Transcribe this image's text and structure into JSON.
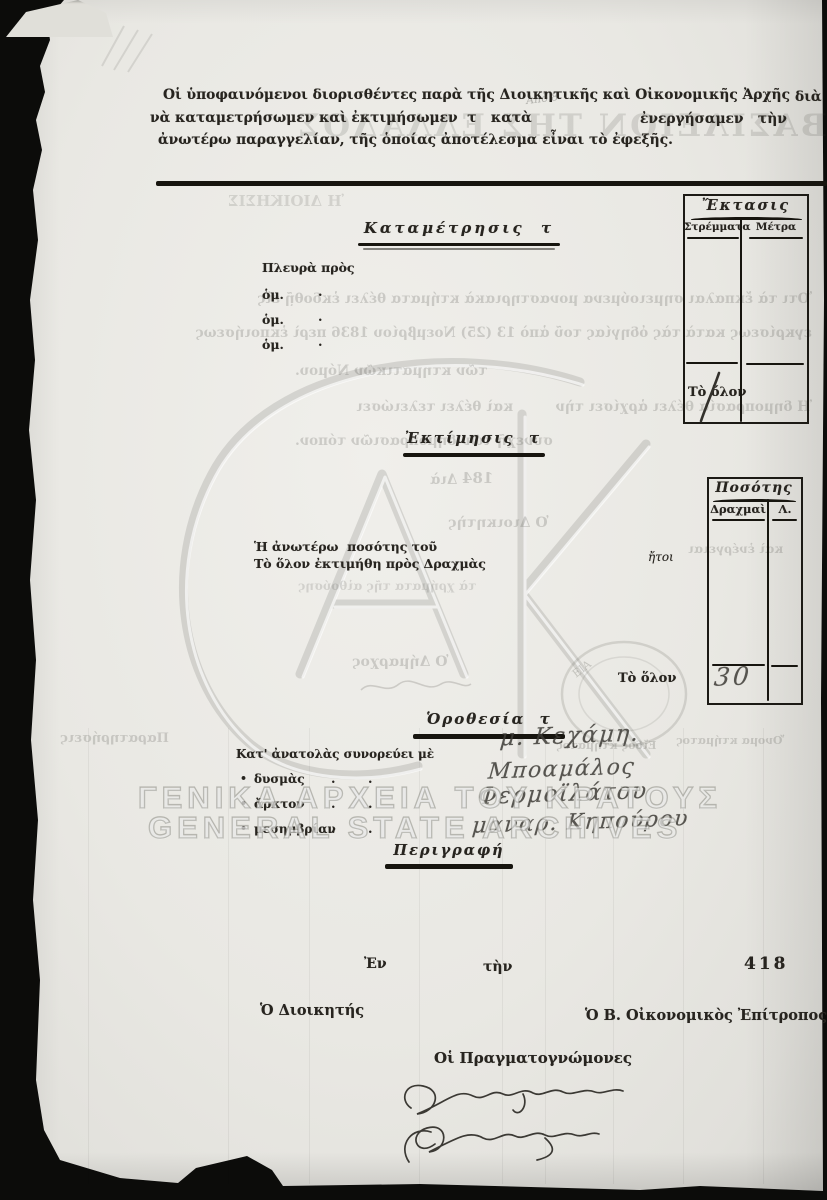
{
  "document": {
    "header": {
      "line1": "Οἱ ὑποφαινόμενοι διορισθέντες παρὰ τῆς Διοικητικῆς καὶ Οἰκονομικῆς Ἀρχῆς",
      "line1_end": "διὰ",
      "line2": "νὰ καταμετρήσωμεν καὶ ἐκτιμήσωμεν  τ   κατὰ",
      "line2_end": "ἐνεργήσαμεν   τὴν",
      "line3": "ἀνωτέρω παραγγελίαν, τῆς ὁποίας ἀποτέλεσμα εἶναι τὸ ἐφεξῆς.",
      "pencil_note": "Ἀπὸ 8"
    },
    "katametrisis": {
      "heading": "Καταμέτρησις  τ",
      "side_label": "Πλευρὰ πρὸς",
      "dim_rows": [
        "ὁμ.",
        "ὁμ.",
        "ὁμ."
      ],
      "dot": ".",
      "total_label": "Τὸ ὅλον"
    },
    "ektasis_table": {
      "title": "Ἔκτασις",
      "col1": "Στρέμματα",
      "col2": "Μέτρα",
      "total_value_handwritten": "1"
    },
    "ektimisis": {
      "heading": "Ἐκτίμησις  τ",
      "line1": "Ἡ ἀνωτέρω  ποσότης τοῦ",
      "line2": "Τὸ ὅλον ἐκτιμήθη πρὸς Δραχμὰς",
      "itoi_label": "ἤτοι",
      "total_label": "Τὸ ὅλον"
    },
    "posotis_table": {
      "title": "Ποσότης",
      "col1": "Δραχμαὶ",
      "col2": "Λ.",
      "total_value_handwritten": "30"
    },
    "orothesia": {
      "heading": "Ὁροθεσία  τ",
      "bullet": "•",
      "east_label": "Κατ' ἀνατολὰς συνορεύει μὲ",
      "west_label": "δυσμὰς",
      "north_label": "ἄρκτον",
      "south_label": "μεσημβρίαν",
      "hw_east": "μ. Κεχάμη.",
      "hw_west": "Μποαμάλος",
      "hw_north": "Φερμοϊλάτου",
      "hw_south": "μαναρ. Κηπούρου"
    },
    "perigrafi_heading": "Περιγραφή",
    "closing": {
      "en_label": "Ἐν",
      "tin_label": "τὴν",
      "protocol_number": "418",
      "governor_label": "Ὁ Διοικητής",
      "commissioner_label": "Ὁ Β. Οἰκονομικὸς Ἐπίτροπος",
      "experts_label": "Οἱ Πραγματογνώμονες"
    }
  },
  "archive_watermark": {
    "greek": "ΓΕΝΙΚΑ ΑΡΧΕΙΑ ΤΟΥ ΚΡΑΤΟΥΣ",
    "english": "GENERAL STATE ARCHIVES"
  },
  "bleed_through": {
    "basileion": "ΒΑΣΙΛΕΙΟΝ ΤΗΣ ΕΛΛΑΔΟΣ",
    "dioikisis": "Ἡ ΔΙΟΙΚΗΣΙΣ",
    "line1": "Ὅτι τὰ ἔκπαλαι σημειούμενα μοναστηριακὰ κτήματα θέλει ἐκδοθῇ εἰς",
    "line2": "ἐγκρίσεως κατὰ τὰς ὁδηγίας τοῦ ἀπὸ 13 (25) Νοεμβρίου 1836 περὶ ἐκποιήσεως",
    "line3": "τῶν κτηματικῶν Νόμου.",
    "line4": "Ἡ δημοπρασία θέλει ἀρχίσει τὴν         καὶ θέλει τελειώσει",
    "line5": "συνεχῆ τῶν δημοπρασιῶν τόπον.",
    "line6": "Διὰ",
    "line6b": "184",
    "line7": "Ὁ Διοικητὴς",
    "line8": "Ὁ Δήμαρχος",
    "line9": "Παρατηρήσεις",
    "line10": "Εἴδος κτήματος",
    "line11": "Ὄνομα κτήματος",
    "line14": "καὶ ἐνέργειαι",
    "line15": "τὰ χρήματα τῆς αἰθούσης"
  },
  "graphics": {
    "monogram": "gak-monogram-watermark",
    "stamp": "circular-archive-stamp",
    "signatures": "handwritten-expert-signatures",
    "colors": {
      "paper": "#e9e8e3",
      "ink": "#27241f",
      "scan_background": "#0c0c0a",
      "watermark": "#8a8a82"
    }
  }
}
